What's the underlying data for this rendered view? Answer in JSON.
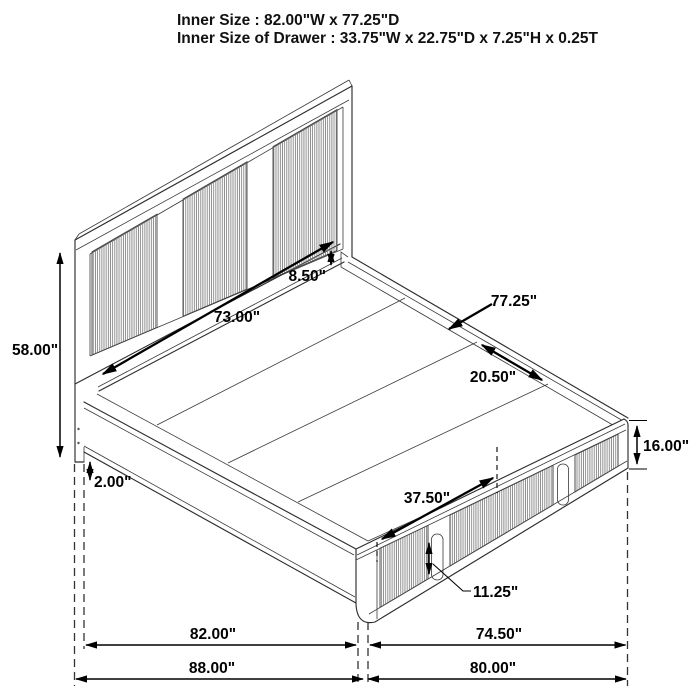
{
  "figure": {
    "type": "technical-line-drawing",
    "subject": "storage platform bed with footboard drawers, isometric dimension diagram"
  },
  "title": {
    "line1": "Inner Size : 82.00\"W x 77.25\"D",
    "line2": "Inner Size of Drawer : 33.75\"W x 22.75\"D x 7.25\"H x 0.25T"
  },
  "dims": {
    "headboard_height": "58.00\"",
    "headboard_width": "73.00\"",
    "headboard_gap": "8.50\"",
    "inner_depth": "77.25\"",
    "deck_panel": "20.50\"",
    "footboard_height": "16.00\"",
    "rail_clearance": "2.00\"",
    "drawer_module": "37.50\"",
    "drawer_front": "11.25\"",
    "inner_width": "82.00\"",
    "footboard_span": "74.50\"",
    "overall_width": "88.00\"",
    "overall_depth": "80.00\""
  },
  "colors": {
    "background": "#ffffff",
    "line": "#2e2e2e",
    "dimension": "#000000",
    "rib": "#7d7d7d"
  }
}
